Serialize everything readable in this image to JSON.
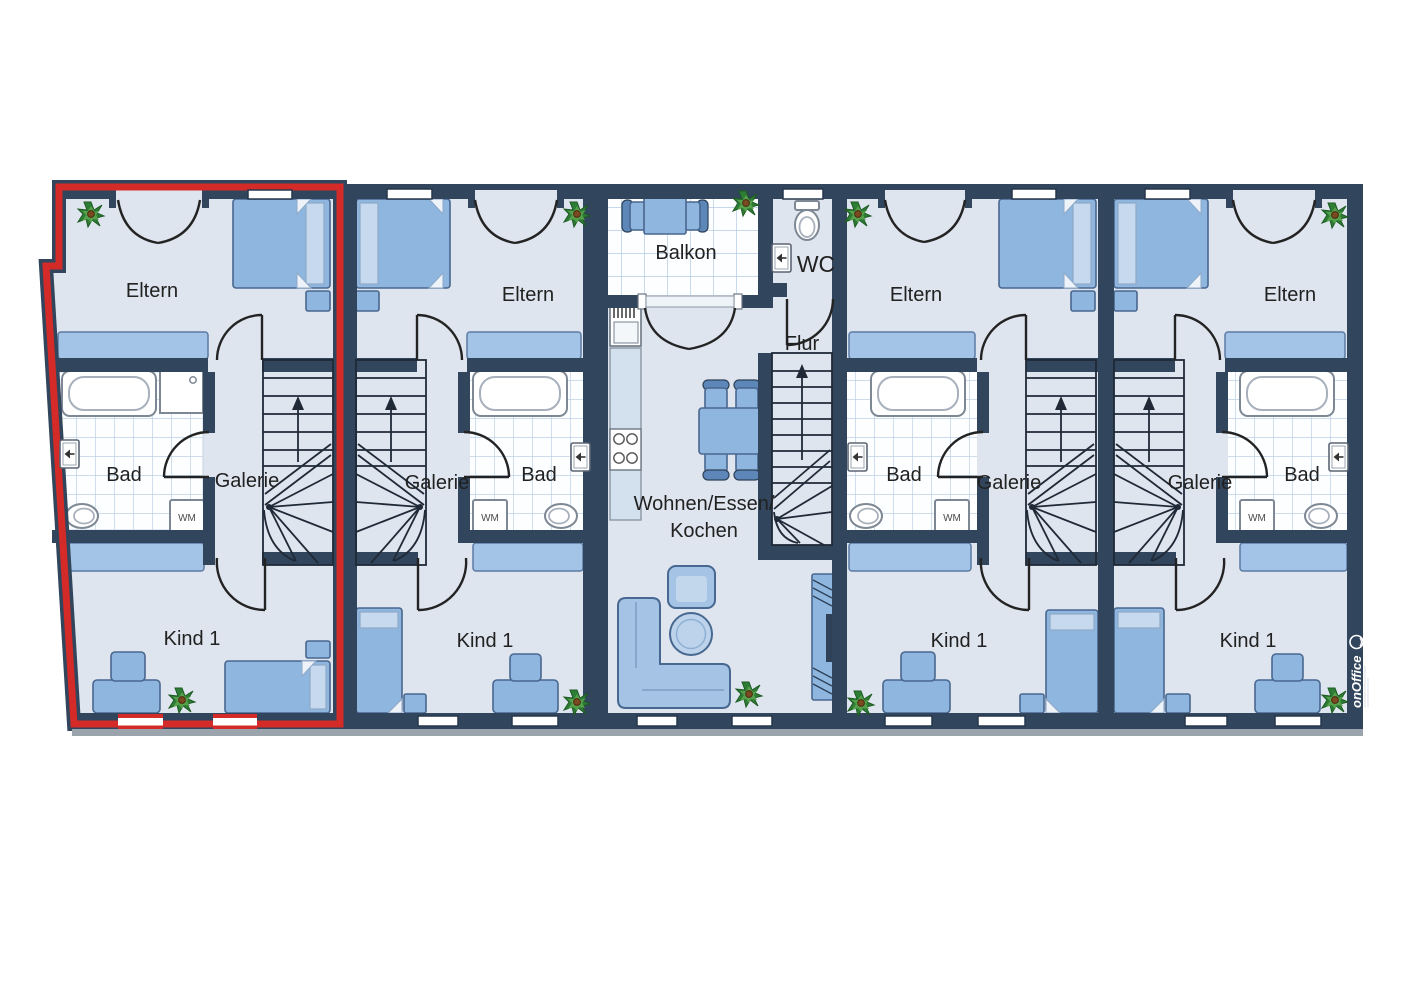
{
  "units": [
    {
      "id": "unit-1",
      "highlighted": true,
      "rooms": {
        "eltern": "Eltern",
        "bad": "Bad",
        "galerie": "Galerie",
        "kind1": "Kind 1"
      }
    },
    {
      "id": "unit-2",
      "highlighted": false,
      "rooms": {
        "eltern": "Eltern",
        "galerie": "Galerie",
        "bad": "Bad",
        "kind1": "Kind 1"
      }
    },
    {
      "id": "unit-3",
      "highlighted": false,
      "rooms": {
        "balkon": "Balkon",
        "wc": "WC",
        "flur": "Flur",
        "wohnen_line1": "Wohnen/Essen/",
        "wohnen_line2": "Kochen"
      }
    },
    {
      "id": "unit-4",
      "highlighted": false,
      "rooms": {
        "eltern": "Eltern",
        "bad": "Bad",
        "galerie": "Galerie",
        "kind1": "Kind 1"
      }
    },
    {
      "id": "unit-5",
      "highlighted": false,
      "rooms": {
        "eltern": "Eltern",
        "galerie": "Galerie",
        "bad": "Bad",
        "kind1": "Kind 1"
      }
    }
  ],
  "labels": {
    "washing_machine": "WM"
  },
  "watermark": {
    "brand": "onOffice"
  },
  "colors": {
    "wall": "#31455c",
    "floor": "#dfe5ee",
    "tile_grid": "#bdd2e6",
    "furniture": "#8fb6de",
    "accent_red": "#d42a28"
  }
}
